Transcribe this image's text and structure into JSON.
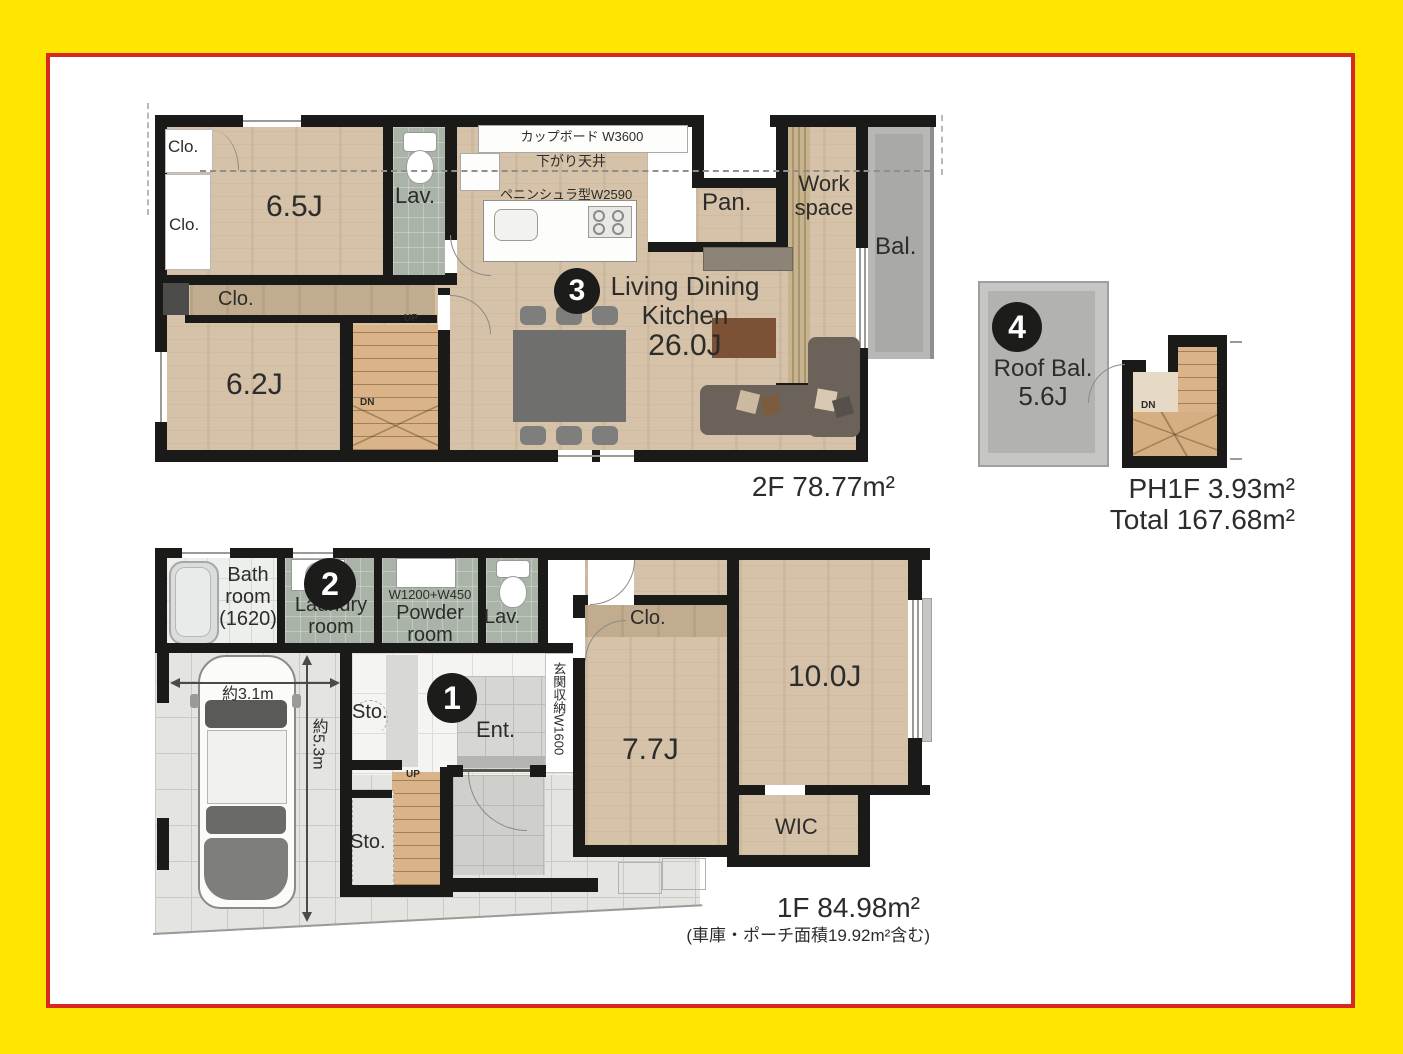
{
  "frame": {
    "outer_color": "#ffe600",
    "inner_line_color": "#d9291e"
  },
  "floor2": {
    "clo_a": "Clo.",
    "clo_b": "Clo.",
    "clo_c": "Clo.",
    "room_65": "6.5J",
    "room_62": "6.2J",
    "lav": "Lav.",
    "cupboard": "カップボード W3600",
    "lowered_ceiling": "下がり天井",
    "peninsula": "ペニンシュラ型W2590",
    "pantry": "Pan.",
    "work_l1": "Work",
    "work_l2": "space",
    "balcony": "Bal.",
    "badge": "3",
    "ldk_l1": "Living Dining",
    "ldk_l2": "Kitchen",
    "ldk_size": "26.0J",
    "up": "UP",
    "dn": "DN",
    "area": "2F 78.77m²"
  },
  "ph": {
    "badge": "4",
    "roof_l1": "Roof Bal.",
    "roof_size": "5.6J",
    "dn": "DN",
    "area": "PH1F 3.93m²",
    "total": "Total 167.68m²"
  },
  "floor1": {
    "bath_l1": "Bath",
    "bath_l2": "room",
    "bath_l3": "(1620)",
    "badge_2": "2",
    "laundry_l1": "Laundry",
    "laundry_l2": "room",
    "powder_w": "W1200+W450",
    "powder_l1": "Powder",
    "powder_l2": "room",
    "lav": "Lav.",
    "car_width": "約3.1m",
    "car_depth": "約5.3m",
    "sto_a": "Sto.",
    "sto_b": "Sto.",
    "badge_1": "1",
    "ent": "Ent.",
    "shoe_cabinet": "玄関収納W1600",
    "up": "UP",
    "clo": "Clo.",
    "room_77": "7.7J",
    "room_10": "10.0J",
    "wic": "WIC",
    "area": "1F 84.98m²",
    "area_note": "(車庫・ポーチ面積19.92m²含む)"
  }
}
